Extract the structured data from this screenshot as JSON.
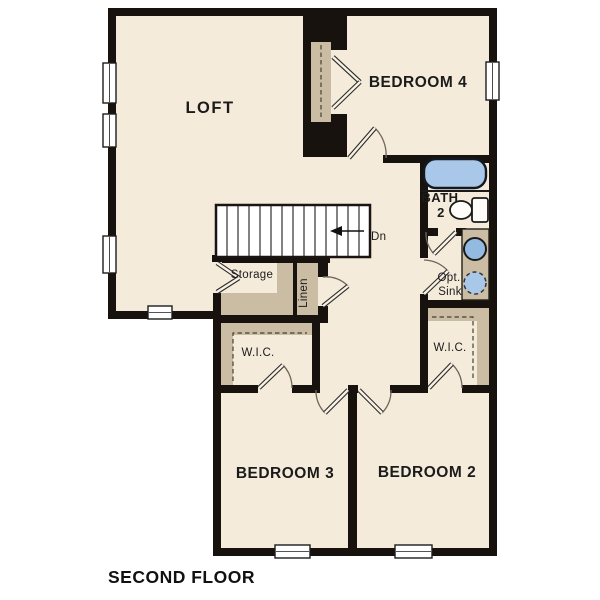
{
  "plan": {
    "title": "SECOND FLOOR",
    "stairs": {
      "direction_label": "Dn"
    },
    "rooms": {
      "loft": {
        "label": "LOFT"
      },
      "bedroom4": {
        "label": "BEDROOM 4"
      },
      "bath2": {
        "label_line1": "BATH",
        "label_line2": "2"
      },
      "opt_sink": {
        "label_line1": "Opt.",
        "label_line2": "Sink"
      },
      "storage": {
        "label": "Storage"
      },
      "linen": {
        "label": "Linen"
      },
      "wic_left": {
        "label": "W.I.C."
      },
      "wic_right": {
        "label": "W.I.C."
      },
      "bedroom3": {
        "label": "BEDROOM 3"
      },
      "bedroom2": {
        "label": "BEDROOM 2"
      }
    },
    "fixtures": {
      "bathtub": "bathtub-icon",
      "toilet": "toilet-icon",
      "sink": "sink-icon",
      "optional_sink": "optional-sink-icon"
    },
    "colors": {
      "wall": "#17120e",
      "floor": "#f5ebdb",
      "shelf": "#cbbda3",
      "tub_fill": "#a9c8e9",
      "sink_fill": "#93bbe2",
      "page_bg": "#ffffff"
    }
  }
}
